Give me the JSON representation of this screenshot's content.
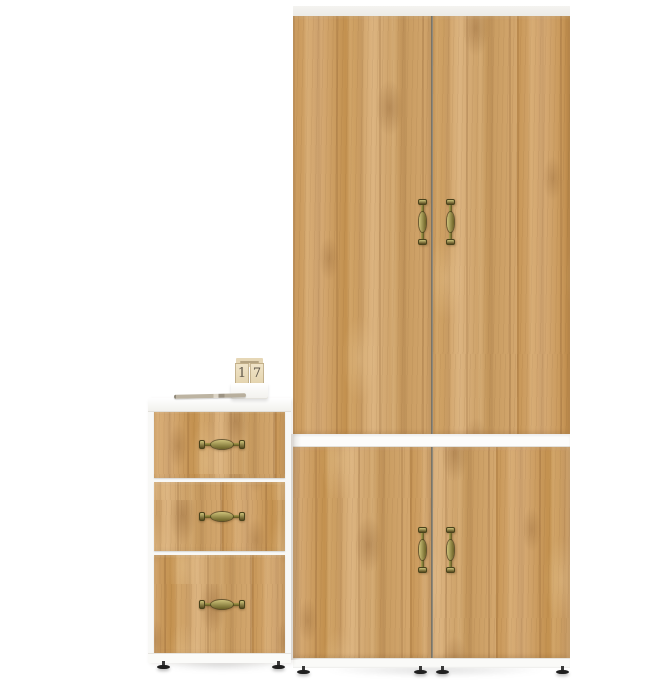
{
  "scene": {
    "type": "furniture product render",
    "background": "white studio floor"
  },
  "colors": {
    "wood_base": "#cfa066",
    "wood_dark": "#b1824a",
    "wood_light": "#e3bd8a",
    "panel_white": "#fafaf8",
    "panel_edge": "#e0ded8",
    "door_gap": "#8a8173",
    "brass": "#8d8440",
    "brass_dark": "#4a431c",
    "brass_light": "#cdc27a",
    "foot": "#1f1f1f",
    "card": "#ecdfc0",
    "digit": "#5f574a"
  },
  "wardrobe": {
    "upper_doors": 2,
    "lower_doors": 2,
    "handle_style": "vertical antique brass pulls",
    "finish": "golden oak, white top strip, white mid divider, white plinth, black feet"
  },
  "chest": {
    "drawers": 3,
    "handle_style": "horizontal antique brass pulls",
    "finish": "golden oak fronts, white carcass and top, black feet"
  },
  "calendar": {
    "digits": [
      "1",
      "7"
    ]
  },
  "desk_items": {
    "pen": "slim pen lying on chest top"
  }
}
